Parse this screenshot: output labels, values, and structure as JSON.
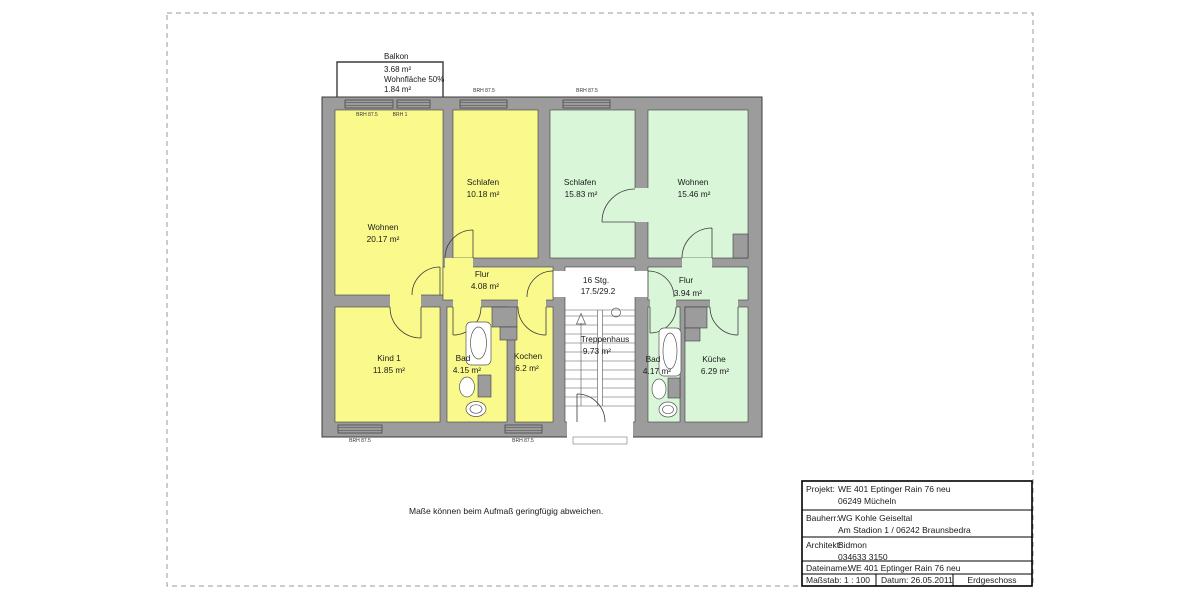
{
  "page": {
    "disclaimer": "Maße können beim Aufmaß geringfügig abweichen."
  },
  "colors": {
    "apartment_left": "#fafa8c",
    "apartment_right": "#d9f6d9",
    "wall": "#9c9c9c",
    "stairwell": "#ffffff"
  },
  "balcony": {
    "title": "Balkon",
    "area": "3.68 m²",
    "note": "Wohnfläche 50%",
    "effective_area": "1.84 m²"
  },
  "annotations": {
    "brh_875": "BRH 87.5",
    "brh_1": "BRH 1"
  },
  "rooms": {
    "wohnen_left": {
      "name": "Wohnen",
      "area": "20.17 m²"
    },
    "schlafen_left": {
      "name": "Schlafen",
      "area": "10.18 m²"
    },
    "flur_left": {
      "name": "Flur",
      "area": "4.08 m²"
    },
    "kind_1": {
      "name": "Kind 1",
      "area": "11.85 m²"
    },
    "bad_left": {
      "name": "Bad",
      "area": "4.15 m²"
    },
    "kochen": {
      "name": "Kochen",
      "area": "6.2 m²"
    },
    "schlafen_right": {
      "name": "Schlafen",
      "area": "15.83 m²"
    },
    "wohnen_right": {
      "name": "Wohnen",
      "area": "15.46 m²"
    },
    "flur_right": {
      "name": "Flur",
      "area": "3.94 m²"
    },
    "bad_right": {
      "name": "Bad",
      "area": "4.17 m²"
    },
    "kueche": {
      "name": "Küche",
      "area": "6.29 m²"
    },
    "treppenhaus": {
      "name": "Treppenhaus",
      "area": "9.73 m²"
    }
  },
  "stairs": {
    "steps": "16 Stg.",
    "rise_run": "17.5/29.2"
  },
  "title_block": {
    "projekt_label": "Projekt:",
    "projekt_line1": "WE 401 Eptinger Rain 76 neu",
    "projekt_line2": "06249 Mücheln",
    "bauherr_label": "Bauherr:",
    "bauherr_line1": "WG Kohle Geiseltal",
    "bauherr_line2": "Am Stadion 1 / 06242 Braunsbedra",
    "architekt_label": "Architekt:",
    "architekt_line1": "Bidmon",
    "architekt_line2": "034633  3150",
    "dateiname_label": "Dateiname:",
    "dateiname_value": "WE 401 Eptinger Rain 76 neu",
    "massstab_label": "Maßstab:",
    "massstab_value": "1 : 100",
    "datum": "Datum: 26.05.2011",
    "geschoss": "Erdgeschoss"
  }
}
